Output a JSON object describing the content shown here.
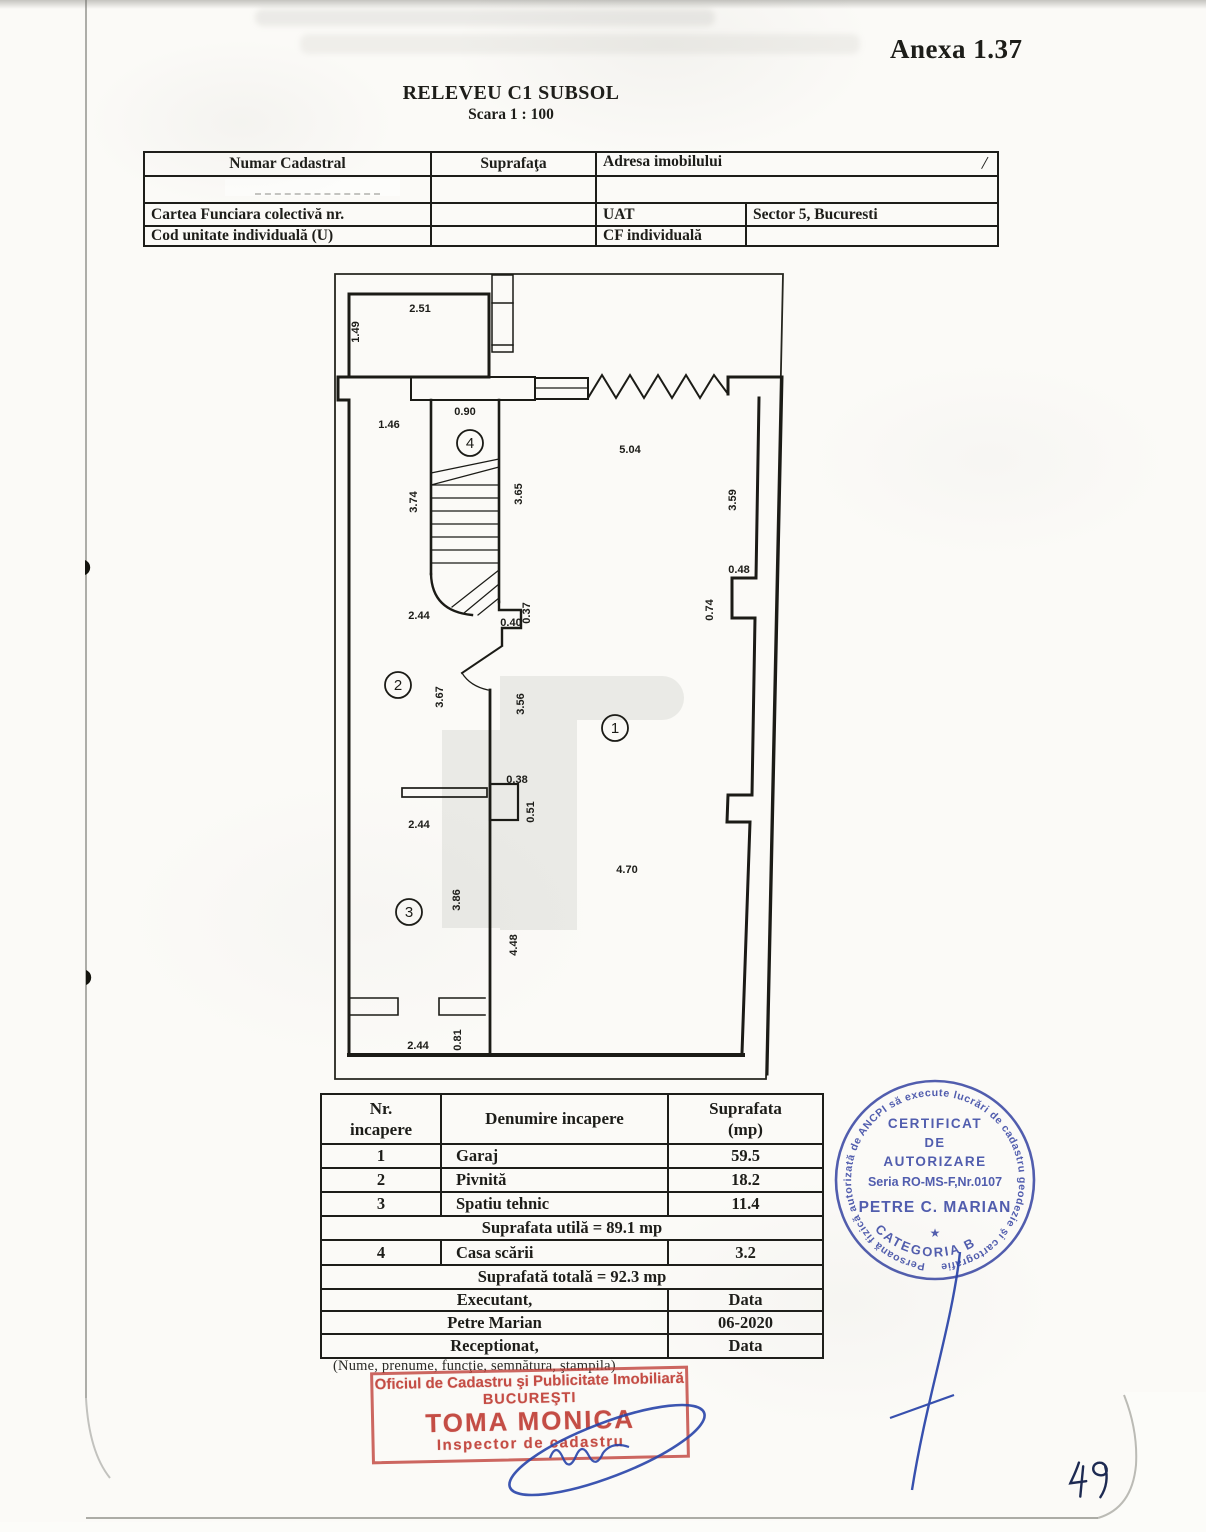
{
  "page": {
    "annex_label": "Anexa 1.37",
    "title": "RELEVEU C1 SUBSOL",
    "scale": "Scara 1 : 100",
    "page_number": "49"
  },
  "cadastral_table": {
    "col_numar": "Numar Cadastral",
    "col_suprafata": "Suprafaţa",
    "col_adresa": "Adresa imobilului",
    "slash_mark": "/",
    "cartea_funciara_label": "Cartea Funciara colectivă nr.",
    "uat_label": "UAT",
    "uat_value": "Sector 5, Bucuresti",
    "cod_unitate_label": "Cod unitate individuală (U)",
    "cf_individuala_label": "CF individuală"
  },
  "plan": {
    "dimensions": [
      "2.51",
      "1.49",
      "0.90",
      "1.46",
      "5.04",
      "3.74",
      "3.65",
      "3.59",
      "0.48",
      "0.74",
      "2.44",
      "0.40",
      "0.37",
      "3.67",
      "3.56",
      "0.38",
      "0.51",
      "2.44",
      "4.70",
      "3.86",
      "4.48",
      "2.44",
      "0.81"
    ],
    "rooms": [
      "1",
      "2",
      "3",
      "4"
    ]
  },
  "rooms_table": {
    "header_nr_1": "Nr.",
    "header_nr_2": "incapere",
    "header_name": "Denumire incapere",
    "header_area_1": "Suprafata",
    "header_area_2": "(mp)",
    "rows": [
      {
        "nr": "1",
        "name": "Garaj",
        "area": "59.5"
      },
      {
        "nr": "2",
        "name": "Pivnită",
        "area": "18.2"
      },
      {
        "nr": "3",
        "name": "Spatiu tehnic",
        "area": "11.4"
      }
    ],
    "useful_area": "Suprafata utilă = 89.1 mp",
    "row4": {
      "nr": "4",
      "name": "Casa scării",
      "area": "3.2"
    },
    "total_area": "Suprafată totală = 92.3 mp",
    "executant_label": "Executant,",
    "executant_name": "Petre Marian",
    "date_label_1": "Data",
    "date_value": "06-2020",
    "receptionat_label": "Receptionat,",
    "date_label_2": "Data",
    "footnote": "(Nume, prenume, funcţie, semnătura, ştampila)"
  },
  "red_stamp": {
    "office_line": "Oficiul de Cadastru şi Publicitate Imobiliară",
    "city": "BUCUREŞTI",
    "name": "TOMA MONICA",
    "role": "Inspector de cadastru",
    "ink_color": "#c04038"
  },
  "round_stamp": {
    "rim_text": "Persoană fizică autorizată de ANCPI să execute lucrări de cadastru geodezie şi cartografie",
    "line1": "CERTIFICAT",
    "line2": "DE",
    "line3": "AUTORIZARE",
    "line4": "Seria RO-MS-F,Nr.0107",
    "name": "PETRE C. MARIAN",
    "star": "★",
    "category": "CATEGORIA B",
    "ink_color": "#3a48a4"
  }
}
